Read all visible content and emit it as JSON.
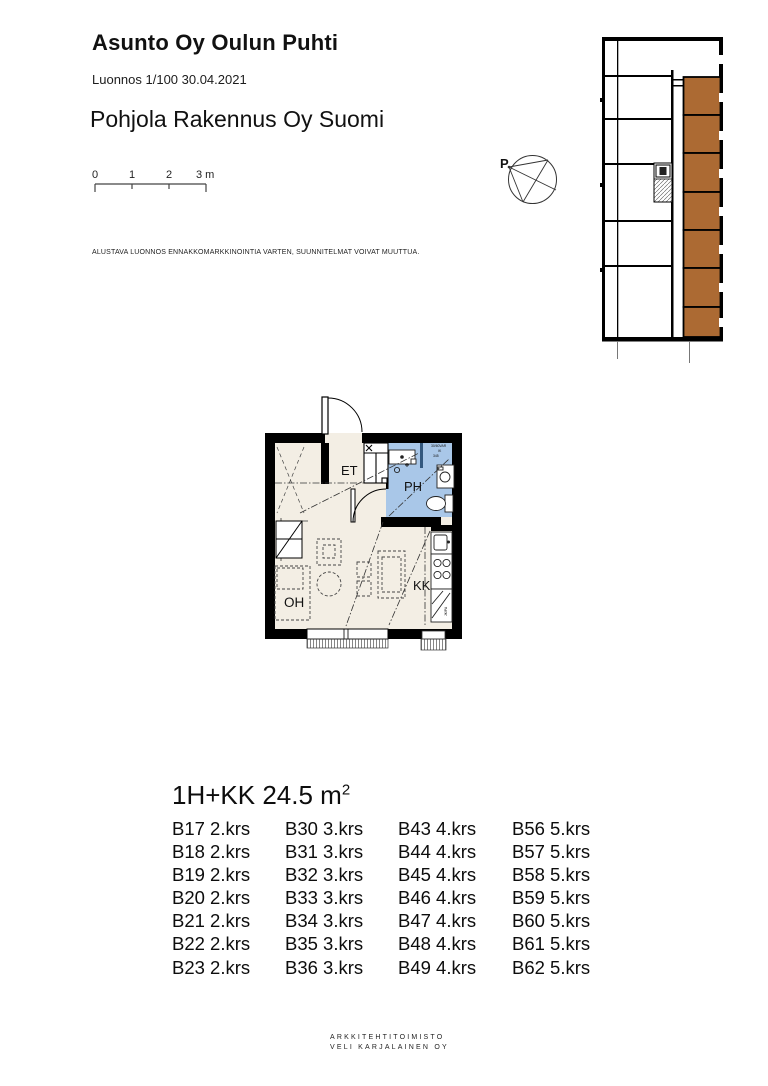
{
  "header": {
    "title": "Asunto Oy Oulun Puhti",
    "subtitle": "Luonnos 1/100 30.04.2021",
    "company": "Pohjola Rakennus Oy Suomi"
  },
  "scale_bar": {
    "labels": [
      "0",
      "1",
      "2",
      "3 m"
    ]
  },
  "disclaimer": {
    "text": "ALUSTAVA LUONNOS ENNAKKOMARKKINOINTIA VARTEN, SUUNNITELMAT VOIVAT MUUTTUA."
  },
  "compass": {
    "label": "P"
  },
  "plan": {
    "rooms": {
      "et": "ET",
      "ph": "PH",
      "oh": "OH",
      "kk": "KK"
    },
    "note": [
      "30/60VAR",
      "IK",
      "345"
    ],
    "fridge_label": "JK/PA"
  },
  "apartment": {
    "heading": "1H+KK 24.5 m",
    "area_sup": "2"
  },
  "units": {
    "rows": [
      [
        "B17 2.krs",
        "B30 3.krs",
        "B43 4.krs",
        "B56 5.krs"
      ],
      [
        "B18 2.krs",
        "B31 3.krs",
        "B44 4.krs",
        "B57 5.krs"
      ],
      [
        "B19 2.krs",
        "B32 3.krs",
        "B45 4.krs",
        "B58 5.krs"
      ],
      [
        "B20 2.krs",
        "B33 3.krs",
        "B46 4.krs",
        "B59 5.krs"
      ],
      [
        "B21 2.krs",
        "B34 3.krs",
        "B47 4.krs",
        "B60 5.krs"
      ],
      [
        "B22 2.krs",
        "B35 3.krs",
        "B48 4.krs",
        "B61 5.krs"
      ],
      [
        "B23 2.krs",
        "B36 3.krs",
        "B49 4.krs",
        "B62 5.krs"
      ]
    ]
  },
  "footer": {
    "line1": "ARKKITEHTITOIMISTO",
    "line2": "VELI KARJALAINEN OY"
  },
  "colors": {
    "highlight_brown": "#AC6A33",
    "bath_blue": "#A9C7E8",
    "floor_beige": "#F3EEE4",
    "wall_black": "#000000"
  }
}
